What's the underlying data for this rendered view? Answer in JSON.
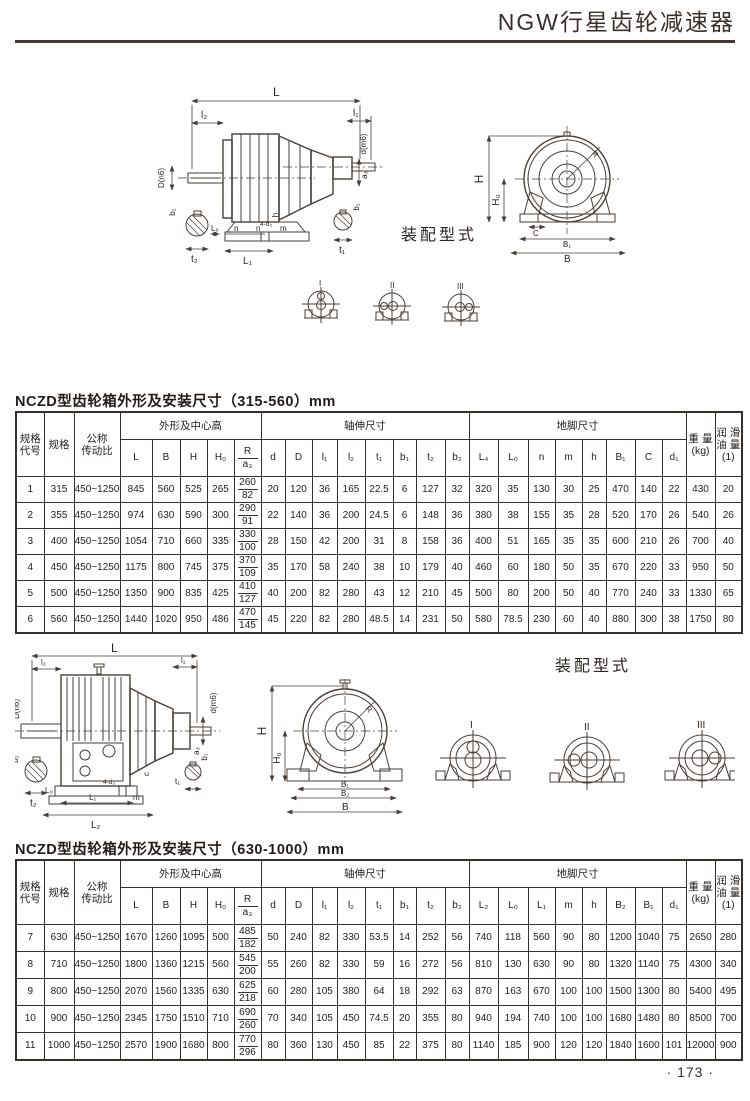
{
  "page": {
    "title": "NGW行星齿轮减速器",
    "page_number": "· 173 ·"
  },
  "drawing1": {
    "assembly_label": "装配型式",
    "types": [
      "I",
      "II",
      "III"
    ],
    "labels": {
      "L": "L",
      "l2": "l₂",
      "l1": "l₁",
      "dm6": "d(m6)",
      "Dn6": "D(n6)",
      "a3": "a₃",
      "t2": "t₂",
      "b2": "b₂",
      "t1": "t₁",
      "b1": "b₁",
      "L0": "L₀",
      "n1": "n",
      "n2": "n",
      "L1": "L₁",
      "m": "m",
      "h": "h",
      "d3": "4-d₃",
      "H": "H",
      "H0": "H₀",
      "C": "C",
      "B1": "B₁",
      "B": "B",
      "R": "R"
    }
  },
  "drawing2": {
    "assembly_label": "装配型式",
    "types": [
      "I",
      "II",
      "III"
    ],
    "labels": {
      "L": "L",
      "l2": "l₂",
      "l1": "l₁",
      "dm6": "d(m6)",
      "Dn6": "D(n6)",
      "a3": "a₃",
      "t2": "t₂",
      "b2": "b₂",
      "t1": "t₁",
      "b1": "b₁",
      "L0": "L₀",
      "L1": "L₁",
      "L2": "L₂",
      "m": "m",
      "c": "c",
      "d3": "4-d₃",
      "H": "H",
      "H0": "H₀",
      "B1": "B₁",
      "B2": "B₂",
      "B": "B",
      "R": "R"
    }
  },
  "table1": {
    "title": "NCZD型齿轮箱外形及安装尺寸（315-560）mm",
    "group_headers": {
      "code": "规格\n代号",
      "spec": "规格",
      "ratio": "公称\n传动比",
      "outline": "外形及中心高",
      "shaft": "轴伸尺寸",
      "foot": "地脚尺寸",
      "weight": "重 量\n(kg)",
      "oil": "润 滑\n油 量\n(1)"
    },
    "outline_cols": [
      "L",
      "B",
      "H",
      "H₀"
    ],
    "r_top": "R",
    "r_bottom": "a₃",
    "shaft_cols": [
      "d",
      "D",
      "l₁",
      "l₂",
      "t₁",
      "b₁",
      "t₂",
      "b₂"
    ],
    "foot_cols": [
      "L₄",
      "L₀",
      "n",
      "m",
      "h",
      "B₁",
      "C",
      "d₁"
    ],
    "rows": [
      {
        "code": "1",
        "spec": "315",
        "ratio": "450~1250",
        "outline": [
          "845",
          "560",
          "525",
          "265"
        ],
        "r": [
          "260",
          "82"
        ],
        "shaft": [
          "20",
          "120",
          "36",
          "165",
          "22.5",
          "6",
          "127",
          "32"
        ],
        "foot": [
          "320",
          "35",
          "130",
          "30",
          "25",
          "470",
          "140",
          "22"
        ],
        "weight": "430",
        "oil": "20"
      },
      {
        "code": "2",
        "spec": "355",
        "ratio": "450~1250",
        "outline": [
          "974",
          "630",
          "590",
          "300"
        ],
        "r": [
          "290",
          "91"
        ],
        "shaft": [
          "22",
          "140",
          "36",
          "200",
          "24.5",
          "6",
          "148",
          "36"
        ],
        "foot": [
          "380",
          "38",
          "155",
          "35",
          "28",
          "520",
          "170",
          "26"
        ],
        "weight": "540",
        "oil": "26"
      },
      {
        "code": "3",
        "spec": "400",
        "ratio": "450~1250",
        "outline": [
          "1054",
          "710",
          "660",
          "335"
        ],
        "r": [
          "330",
          "100"
        ],
        "shaft": [
          "28",
          "150",
          "42",
          "200",
          "31",
          "8",
          "158",
          "36"
        ],
        "foot": [
          "400",
          "51",
          "165",
          "35",
          "35",
          "600",
          "210",
          "26"
        ],
        "weight": "700",
        "oil": "40"
      },
      {
        "code": "4",
        "spec": "450",
        "ratio": "450~1250",
        "outline": [
          "1175",
          "800",
          "745",
          "375"
        ],
        "r": [
          "370",
          "109"
        ],
        "shaft": [
          "35",
          "170",
          "58",
          "240",
          "38",
          "10",
          "179",
          "40"
        ],
        "foot": [
          "460",
          "60",
          "180",
          "50",
          "35",
          "670",
          "220",
          "33"
        ],
        "weight": "950",
        "oil": "50"
      },
      {
        "code": "5",
        "spec": "500",
        "ratio": "450~1250",
        "outline": [
          "1350",
          "900",
          "835",
          "425"
        ],
        "r": [
          "410",
          "127"
        ],
        "shaft": [
          "40",
          "200",
          "82",
          "280",
          "43",
          "12",
          "210",
          "45"
        ],
        "foot": [
          "500",
          "80",
          "200",
          "50",
          "40",
          "770",
          "240",
          "33"
        ],
        "weight": "1330",
        "oil": "65"
      },
      {
        "code": "6",
        "spec": "560",
        "ratio": "450~1250",
        "outline": [
          "1440",
          "1020",
          "950",
          "486"
        ],
        "r": [
          "470",
          "145"
        ],
        "shaft": [
          "45",
          "220",
          "82",
          "280",
          "48.5",
          "14",
          "231",
          "50"
        ],
        "foot": [
          "580",
          "78.5",
          "230",
          "60",
          "40",
          "880",
          "300",
          "38"
        ],
        "weight": "1750",
        "oil": "80"
      }
    ]
  },
  "table2": {
    "title": "NCZD型齿轮箱外形及安装尺寸（630-1000）mm",
    "group_headers": {
      "code": "规格\n代号",
      "spec": "规格",
      "ratio": "公称\n传动比",
      "outline": "外形及中心高",
      "shaft": "轴伸尺寸",
      "foot": "地脚尺寸",
      "weight": "重 量\n(kg)",
      "oil": "润 滑\n油 量\n(1)"
    },
    "outline_cols": [
      "L",
      "B",
      "H",
      "H₀"
    ],
    "r_top": "R",
    "r_bottom": "a₃",
    "shaft_cols": [
      "d",
      "D",
      "l₁",
      "l₂",
      "t₁",
      "b₁",
      "t₂",
      "b₂"
    ],
    "foot_cols": [
      "L₂",
      "L₀",
      "L₁",
      "m",
      "h",
      "B₂",
      "B₁",
      "d₁"
    ],
    "rows": [
      {
        "code": "7",
        "spec": "630",
        "ratio": "450~1250",
        "outline": [
          "1670",
          "1260",
          "1095",
          "500"
        ],
        "r": [
          "485",
          "182"
        ],
        "shaft": [
          "50",
          "240",
          "82",
          "330",
          "53.5",
          "14",
          "252",
          "56"
        ],
        "foot": [
          "740",
          "118",
          "560",
          "90",
          "80",
          "1200",
          "1040",
          "75"
        ],
        "weight": "2650",
        "oil": "280"
      },
      {
        "code": "8",
        "spec": "710",
        "ratio": "450~1250",
        "outline": [
          "1800",
          "1360",
          "1215",
          "560"
        ],
        "r": [
          "545",
          "200"
        ],
        "shaft": [
          "55",
          "260",
          "82",
          "330",
          "59",
          "16",
          "272",
          "56"
        ],
        "foot": [
          "810",
          "130",
          "630",
          "90",
          "80",
          "1320",
          "1140",
          "75"
        ],
        "weight": "4300",
        "oil": "340"
      },
      {
        "code": "9",
        "spec": "800",
        "ratio": "450~1250",
        "outline": [
          "2070",
          "1560",
          "1335",
          "630"
        ],
        "r": [
          "625",
          "218"
        ],
        "shaft": [
          "60",
          "280",
          "105",
          "380",
          "64",
          "18",
          "292",
          "63"
        ],
        "foot": [
          "870",
          "163",
          "670",
          "100",
          "100",
          "1500",
          "1300",
          "80"
        ],
        "weight": "5400",
        "oil": "495"
      },
      {
        "code": "10",
        "spec": "900",
        "ratio": "450~1250",
        "outline": [
          "2345",
          "1750",
          "1510",
          "710"
        ],
        "r": [
          "690",
          "260"
        ],
        "shaft": [
          "70",
          "340",
          "105",
          "450",
          "74.5",
          "20",
          "355",
          "80"
        ],
        "foot": [
          "940",
          "194",
          "740",
          "100",
          "100",
          "1680",
          "1480",
          "80"
        ],
        "weight": "8500",
        "oil": "700"
      },
      {
        "code": "11",
        "spec": "1000",
        "ratio": "450~1250",
        "outline": [
          "2570",
          "1900",
          "1680",
          "800"
        ],
        "r": [
          "770",
          "296"
        ],
        "shaft": [
          "80",
          "360",
          "130",
          "450",
          "85",
          "22",
          "375",
          "80"
        ],
        "foot": [
          "1140",
          "185",
          "900",
          "120",
          "120",
          "1840",
          "1600",
          "101"
        ],
        "weight": "12000",
        "oil": "900"
      }
    ]
  }
}
